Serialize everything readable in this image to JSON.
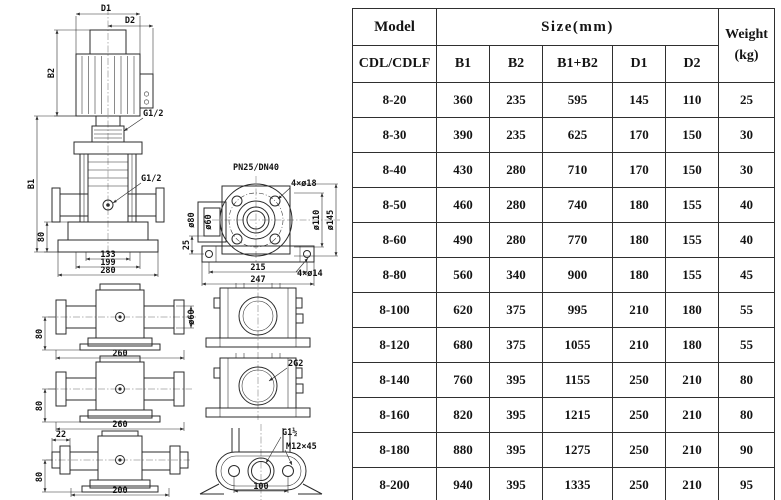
{
  "table": {
    "header": {
      "model": "Model",
      "size": "Size(mm)",
      "weight_line1": "Weight",
      "weight_line2": "(kg)",
      "model_sub": "CDL/CDLF",
      "cols": [
        "B1",
        "B2",
        "B1+B2",
        "D1",
        "D2"
      ]
    },
    "rows": [
      [
        "8-20",
        "360",
        "235",
        "595",
        "145",
        "110",
        "25"
      ],
      [
        "8-30",
        "390",
        "235",
        "625",
        "170",
        "150",
        "30"
      ],
      [
        "8-40",
        "430",
        "280",
        "710",
        "170",
        "150",
        "30"
      ],
      [
        "8-50",
        "460",
        "280",
        "740",
        "180",
        "155",
        "40"
      ],
      [
        "8-60",
        "490",
        "280",
        "770",
        "180",
        "155",
        "40"
      ],
      [
        "8-80",
        "560",
        "340",
        "900",
        "180",
        "155",
        "45"
      ],
      [
        "8-100",
        "620",
        "375",
        "995",
        "210",
        "180",
        "55"
      ],
      [
        "8-120",
        "680",
        "375",
        "1055",
        "210",
        "180",
        "55"
      ],
      [
        "8-140",
        "760",
        "395",
        "1155",
        "250",
        "210",
        "80"
      ],
      [
        "8-160",
        "820",
        "395",
        "1215",
        "250",
        "210",
        "80"
      ],
      [
        "8-180",
        "880",
        "395",
        "1275",
        "250",
        "210",
        "90"
      ],
      [
        "8-200",
        "940",
        "395",
        "1335",
        "250",
        "210",
        "95"
      ]
    ]
  },
  "drawing": {
    "front_view": {
      "d1": "D1",
      "d2": "D2",
      "b2": "B2",
      "b1": "B1",
      "vent": "G1/2",
      "drain": "G1/2",
      "base_h": "80",
      "dim_inner": "133",
      "dim_mid": "199",
      "dim_outer": "280"
    },
    "flange_view": {
      "title": "PN25/DN40",
      "bolt_holes": "4×ø18",
      "dia_outer_sleeve": "ø80",
      "dia_sleeve": "ø60",
      "dia_bolt_circle": "ø110",
      "dia_flange": "ø145",
      "offset": "25",
      "dim_bolt_span": "215",
      "dim_base": "247",
      "base_holes": "4×ø14"
    },
    "port_view_a": {
      "h": "80",
      "w": "260",
      "dia": "ø60"
    },
    "port_view_b": {
      "h": "80",
      "w": "260"
    },
    "port_view_c": {
      "nut": "22",
      "h": "80",
      "w": "200"
    },
    "face_view_b": {
      "port": "2G2"
    },
    "oval_flange_view": {
      "thread": "G1½",
      "bolt": "M12×45",
      "w": "100"
    }
  }
}
